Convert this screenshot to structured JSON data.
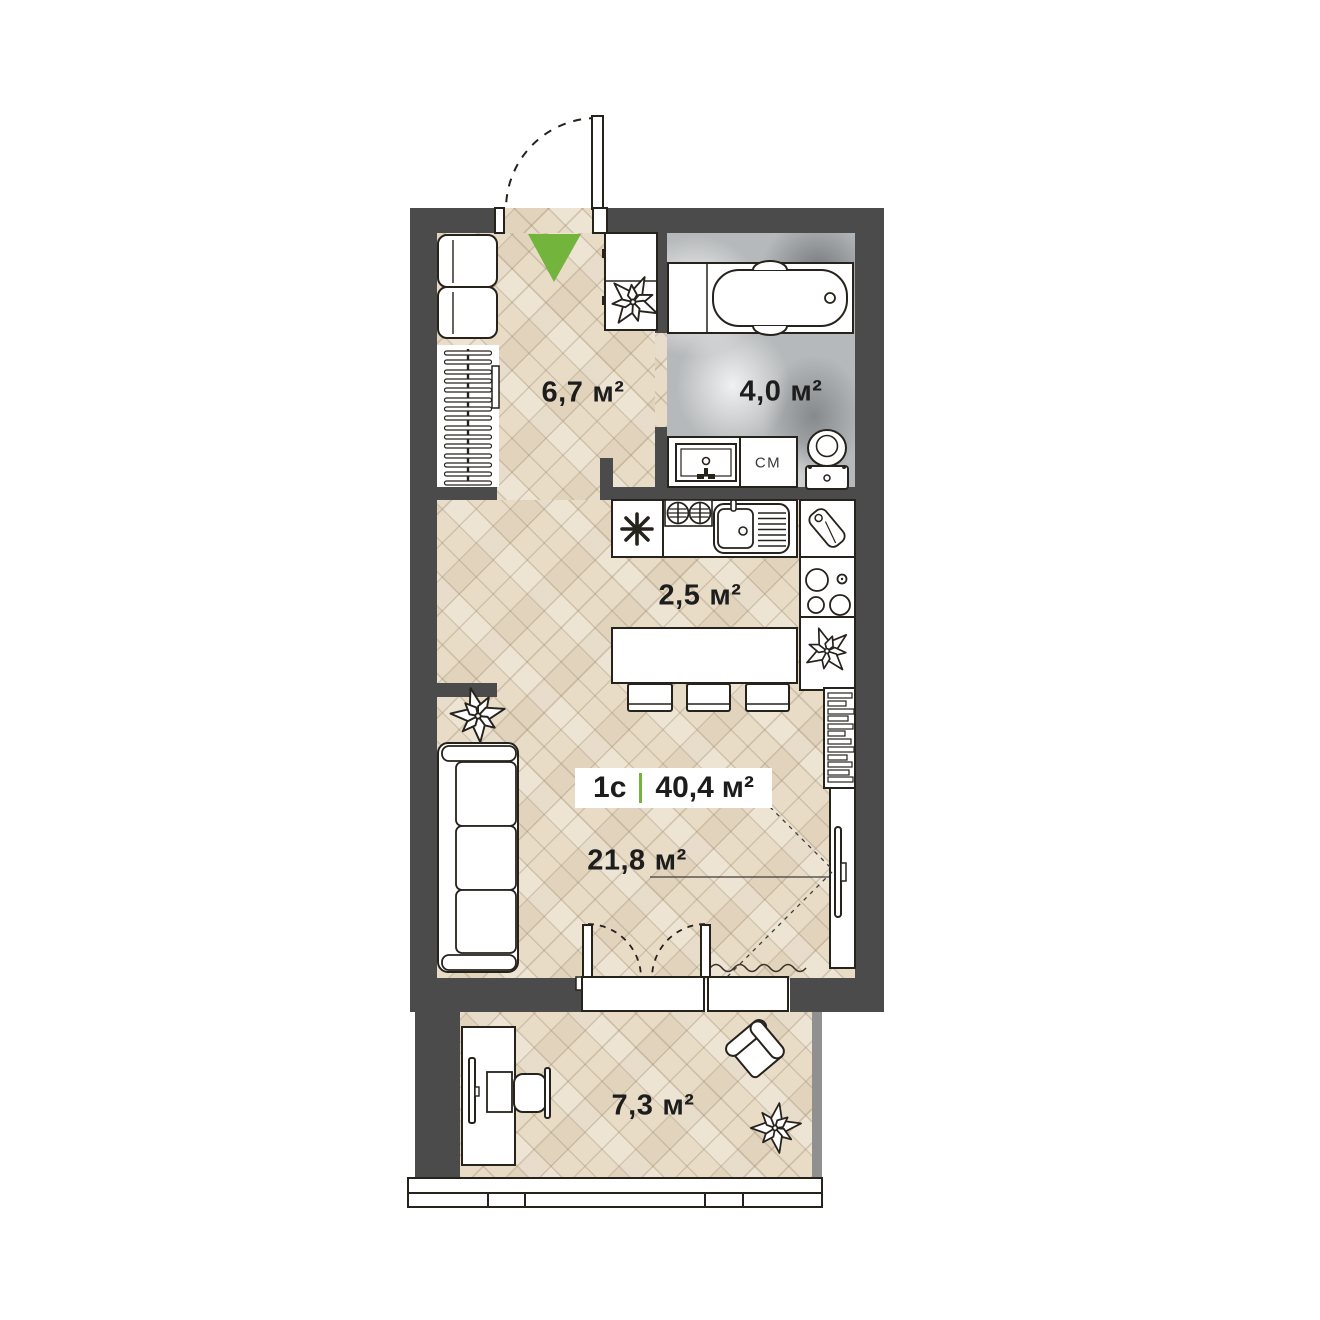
{
  "plan": {
    "type_label": "1с",
    "total_area": "40,4",
    "area_unit": "м²",
    "rooms": [
      {
        "id": "hallway",
        "area": "6,7"
      },
      {
        "id": "bathroom",
        "area": "4,0"
      },
      {
        "id": "kitchen",
        "area": "2,5"
      },
      {
        "id": "living-room",
        "area": "21,8"
      },
      {
        "id": "balcony",
        "area": "7,3"
      }
    ],
    "washer_label": "СМ",
    "colors": {
      "wall": "#4b4b4b",
      "accent_green": "#72b43c",
      "parquet": "#e8dcc7",
      "marble": "#b6b9bb"
    }
  }
}
